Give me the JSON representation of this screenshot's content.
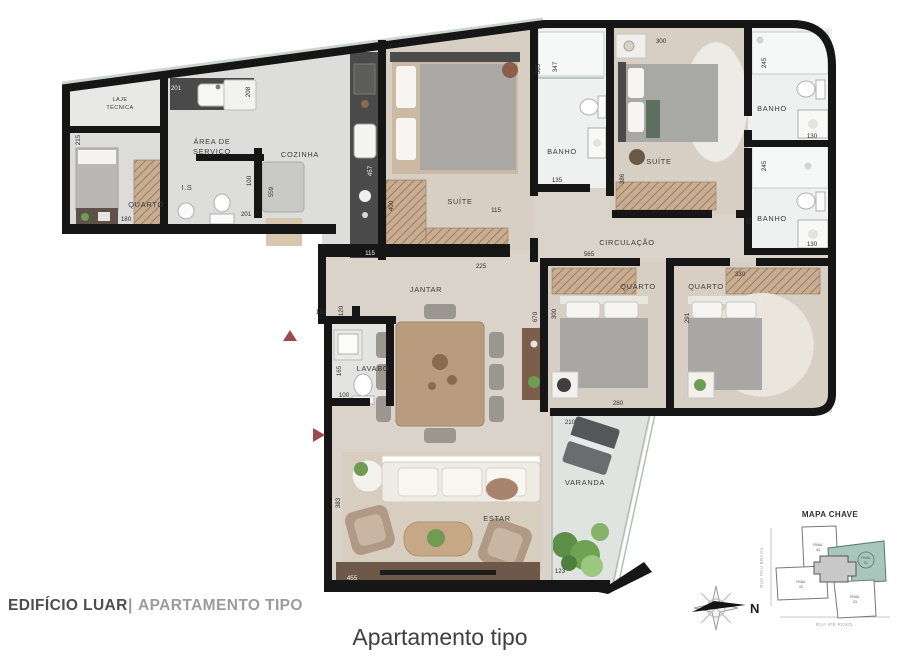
{
  "caption": "Apartamento tipo",
  "footer": {
    "project": "EDIFÍCIO LUAR",
    "separator": "|",
    "subtitle": "APARTAMENTO TIPO"
  },
  "rooms": {
    "laje_1": "LAJE",
    "laje_2": "TÉCNICA",
    "quarto": "QUARTO",
    "area_1": "ÁREA DE",
    "area_2": "SERVIÇO",
    "is": "I.S",
    "cozinha": "COZINHA",
    "suite": "SUÍTE",
    "banho": "BANHO",
    "circulacao": "CIRCULAÇÃO",
    "jantar": "JANTAR",
    "lavabo": "LAVABO",
    "estar": "ESTAR",
    "varanda": "VARANDA"
  },
  "dims": {
    "service_sink": "201",
    "service_right": "208",
    "quarto1_left": "215",
    "quarto1_bottom": "180",
    "is_right": "100",
    "is_bottom": "201",
    "island": "559",
    "counter": "457",
    "cozinha_bottom": "115",
    "suite1_closet": "400",
    "suite1_inner": "115",
    "suite1_bottom": "225",
    "suite1_right": "385",
    "banho1_left": "347",
    "banho1_bottom": "135",
    "suite2_top": "300",
    "suite2_left": "386",
    "banho2_side": "245",
    "banho2_bottom": "130",
    "banho3_side": "245",
    "banho3_left": "95",
    "banho3_bottom": "130",
    "quarto2_top": "565",
    "quarto2_left": "300",
    "quarto2_bottom": "280",
    "jantar_right": "670",
    "quarto3_top": "330",
    "quarto3_left": "291",
    "hall_top": "132",
    "lavabo_top": "120",
    "lavabo_left": "165",
    "lavabo_bottom": "100",
    "estar_left": "383",
    "tv_wall": "455",
    "varanda_top": "210",
    "varanda_bottom": "123"
  },
  "key_map": {
    "title": "MAPA CHAVE",
    "street_left": "RUA PAU BRASIL",
    "street_bottom": "RUA IPÊ ROXO",
    "compass_north": "N",
    "blocks": [
      {
        "line1": "FINAL",
        "line2": "04"
      },
      {
        "line1": "FINAL",
        "line2": "01"
      },
      {
        "line1": "FINAL",
        "line2": "02"
      },
      {
        "line1": "FINAL",
        "line2": "03"
      }
    ]
  },
  "colors": {
    "wall": "#161616",
    "highlight_block": "#a9c6bd",
    "entry_arrow": "#9c4a50"
  }
}
